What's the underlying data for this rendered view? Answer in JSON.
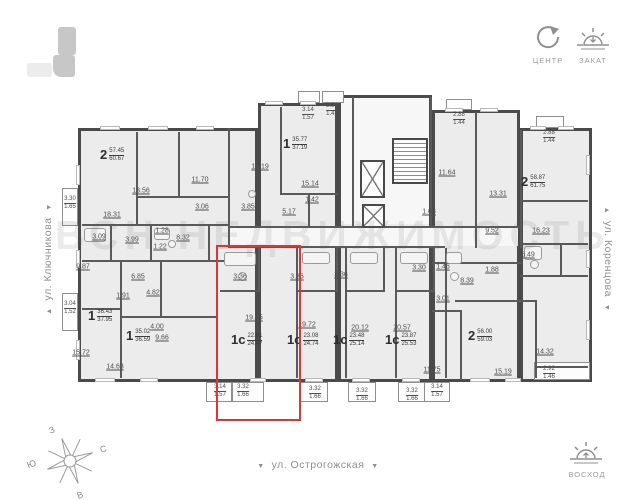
{
  "watermark": "ВСН НЕДВИЖИМОСТЬ",
  "legend": {
    "center_label": "ЦЕНТР",
    "sunset_label": "ЗАКАТ",
    "sunrise_label": "ВОСХОД"
  },
  "compass": {
    "north": "С",
    "south": "Ю",
    "west": "З",
    "east": "В"
  },
  "streets": {
    "left": "ул. Ключникова",
    "right": "ул. Коренцова",
    "bottom": "ул. Острогожская",
    "arrow_down": "▼",
    "arrow_up": "▲"
  },
  "selected_apartment": {
    "type": "1с",
    "area_living": "22.81",
    "area_total": "24.47"
  },
  "apartments": [
    {
      "type": "2",
      "area": "57.45",
      "total": "60.67",
      "selected": false
    },
    {
      "type": "1",
      "area": "35.77",
      "total": "37.19",
      "selected": false
    },
    {
      "type": "2",
      "area": "58.87",
      "total": "61.75",
      "selected": false
    },
    {
      "type": "1",
      "area": "36.43",
      "total": "37.95",
      "selected": false
    },
    {
      "type": "1",
      "area": "35.02",
      "total": "36.59",
      "selected": false
    },
    {
      "type": "1с",
      "area": "22.81",
      "total": "24.47",
      "selected": true
    },
    {
      "type": "1с",
      "area": "23.08",
      "total": "24.74",
      "selected": false
    },
    {
      "type": "1с",
      "area": "23.48",
      "total": "25.14",
      "selected": false
    },
    {
      "type": "1с",
      "area": "23.87",
      "total": "25.53",
      "selected": false
    },
    {
      "type": "2",
      "area": "56.00",
      "total": "59.03",
      "selected": false
    }
  ],
  "rooms": [
    "13.56",
    "18.31",
    "11.70",
    "3.06",
    "8.32",
    "1.28",
    "1.22",
    "3.99",
    "3.09",
    "9.87",
    "6.85",
    "1.91",
    "4.82",
    "15.72",
    "14.63",
    "4.00",
    "9.66",
    "10.19",
    "15.14",
    "1.42",
    "5.17",
    "3.85",
    "11.64",
    "13.31",
    "1.68",
    "9.52",
    "16.23",
    "6.49",
    "1.88",
    "8.39",
    "1.46",
    "3.30",
    "3.01",
    "3.36",
    "3.36",
    "3.36",
    "19.45",
    "19.72",
    "20.12",
    "20.57",
    "11.75",
    "15.19",
    "14.32"
  ],
  "balconies": [
    {
      "size": "3.30",
      "half": "1.65"
    },
    {
      "size": "3.04",
      "half": "1.52"
    },
    {
      "size": "3.14",
      "half": "1.57"
    },
    {
      "size": "2.84",
      "half": "1.42"
    },
    {
      "size": "2.88",
      "half": "1.44"
    },
    {
      "size": "2.88",
      "half": "1.44"
    },
    {
      "size": "3.14",
      "half": "1.57"
    },
    {
      "size": "3.32",
      "half": "1.66"
    },
    {
      "size": "3.32",
      "half": "1.66"
    },
    {
      "size": "3.32",
      "half": "1.66"
    },
    {
      "size": "3.32",
      "half": "1.66"
    },
    {
      "size": "3.14",
      "half": "1.57"
    },
    {
      "size": "2.92",
      "half": "1.46"
    }
  ],
  "colors": {
    "highlight": "#e23434",
    "wall": "#4a4a4a",
    "room_fill": "#ececec"
  }
}
